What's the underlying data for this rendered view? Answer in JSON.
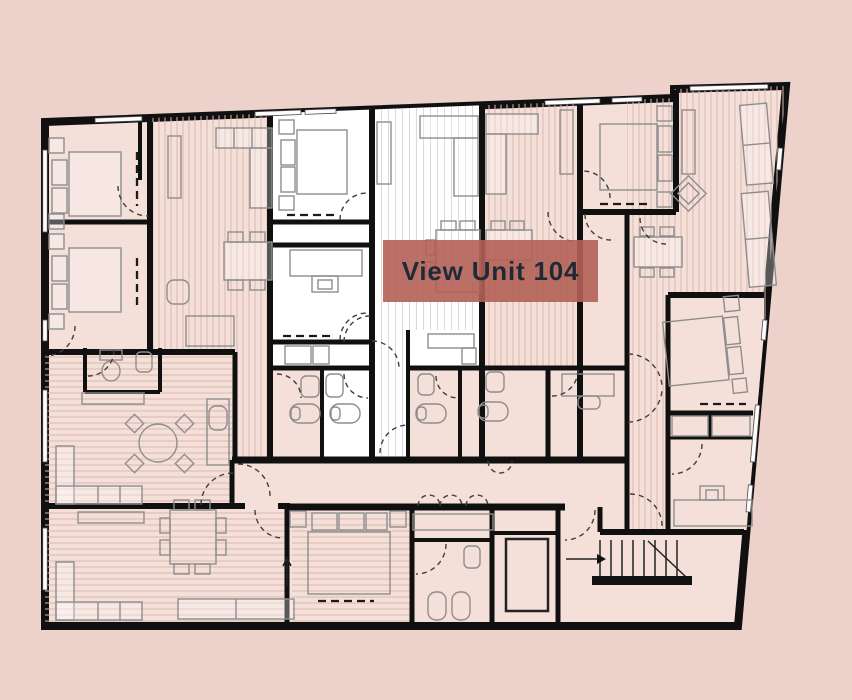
{
  "button": {
    "label": "View Unit 104"
  },
  "colors": {
    "background": "#edd2cc",
    "wall": "#101010",
    "room_pink": "#f4dfd9",
    "room_white": "#ffffff",
    "hatch_pink": "#dcb9b0",
    "hatch_white": "#dadada",
    "furniture": "#8d8d8d",
    "door": "#3f3f3f",
    "button_bg": "rgba(179,97,85,0.9)",
    "button_text": "#1e2b36"
  }
}
